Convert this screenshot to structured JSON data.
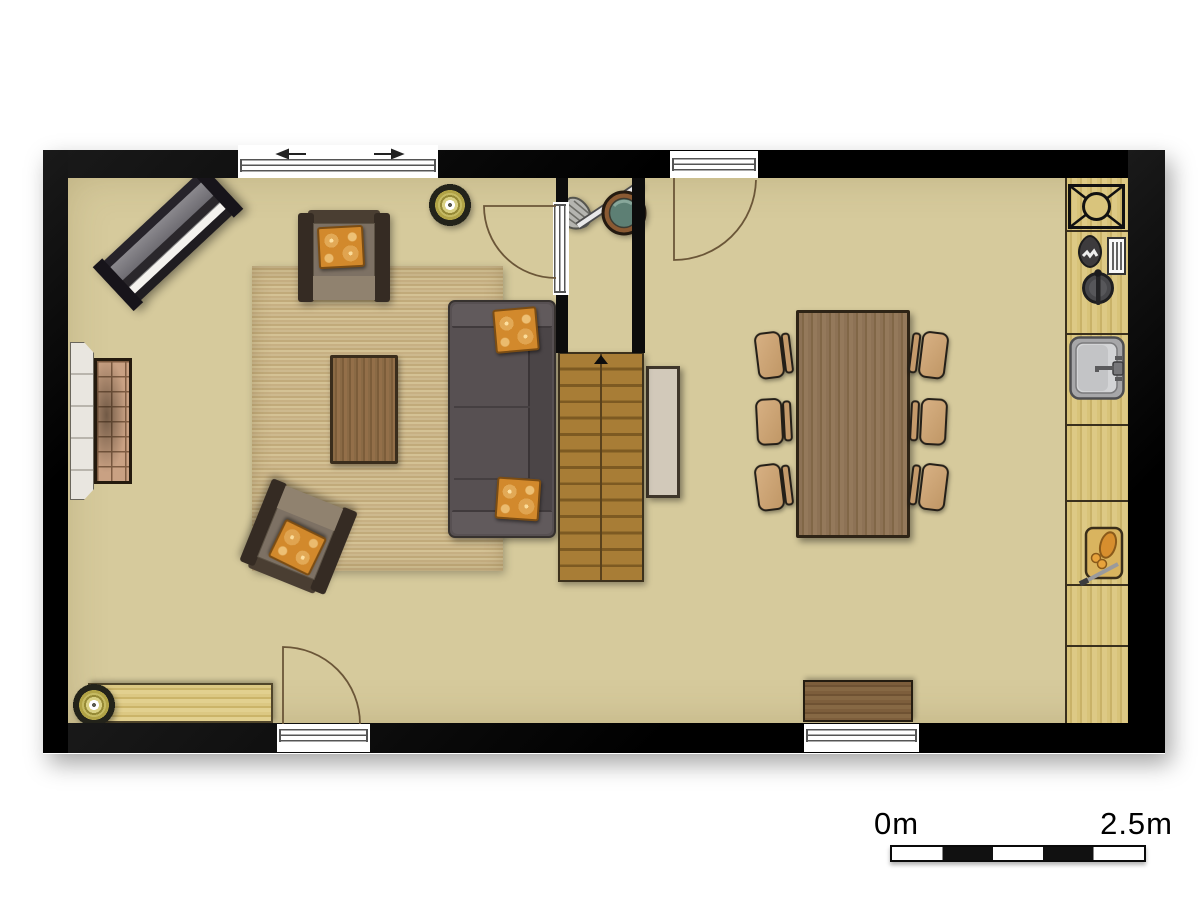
{
  "scale_bar": {
    "start_label": "0m",
    "end_label": "2.5m",
    "segments": 5,
    "length_meters": 2.5
  },
  "palette": {
    "floor": "#d6ca9c",
    "wall": "#0d0d0d",
    "rug": "#c8b284",
    "sofa": "#575052",
    "pillow_accent": "#d2892c",
    "table_wood": "#8d7255",
    "counter_wood": "#d8c379",
    "stairs_wood": "#a87d36",
    "chair_tan": "#cfa87a"
  },
  "symbols": {
    "living_room": [
      "piano",
      "fireplace",
      "rug",
      "sofa",
      "coffee-table",
      "armchair",
      "armchair",
      "sideboard",
      "ceiling-light",
      "ceiling-light",
      "sliding-window",
      "hinged-door"
    ],
    "hallway": [
      "mop-and-bucket",
      "staircase-up",
      "hinged-door"
    ],
    "dining_room": [
      "dining-table",
      "six-chairs",
      "cabinet",
      "bench",
      "window",
      "hinged-door"
    ],
    "kitchen": [
      "extractor-unit",
      "coffee-machine",
      "cutting-board-small",
      "pot",
      "sink",
      "dishwasher",
      "bread-board",
      "cooktop",
      "oven"
    ]
  },
  "openings": {
    "windows": 2,
    "exterior_doors": 2,
    "interior_doors": 1,
    "sliding_windows": 1
  }
}
